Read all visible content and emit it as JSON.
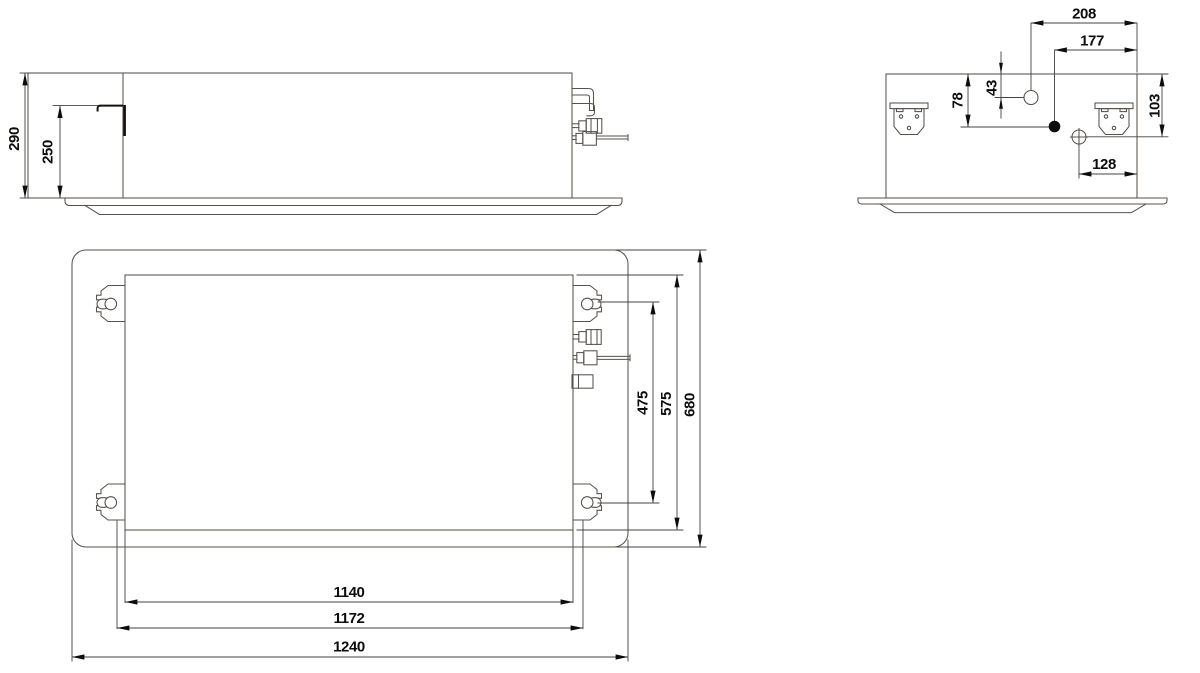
{
  "dimensions": {
    "front_view": {
      "overall_height": "290",
      "hanger_level_height": "250"
    },
    "side_view": {
      "knockout_top_offset": "208",
      "knockout_mid_offset": "177",
      "knockout_top_drop": "43",
      "knockout_mid_drop": "78",
      "side_hole_drop": "103",
      "drain_edge_offset": "128"
    },
    "plan_view": {
      "hanger_pitch_depth": "475",
      "body_depth": "575",
      "panel_depth": "680",
      "hanger_pitch_width": "1140",
      "body_width": "1172",
      "panel_width": "1240"
    }
  },
  "colors": {
    "background": "#ffffff",
    "outline": "#57524e",
    "dimension": "#47433f",
    "ink": "#0e0d0c"
  }
}
